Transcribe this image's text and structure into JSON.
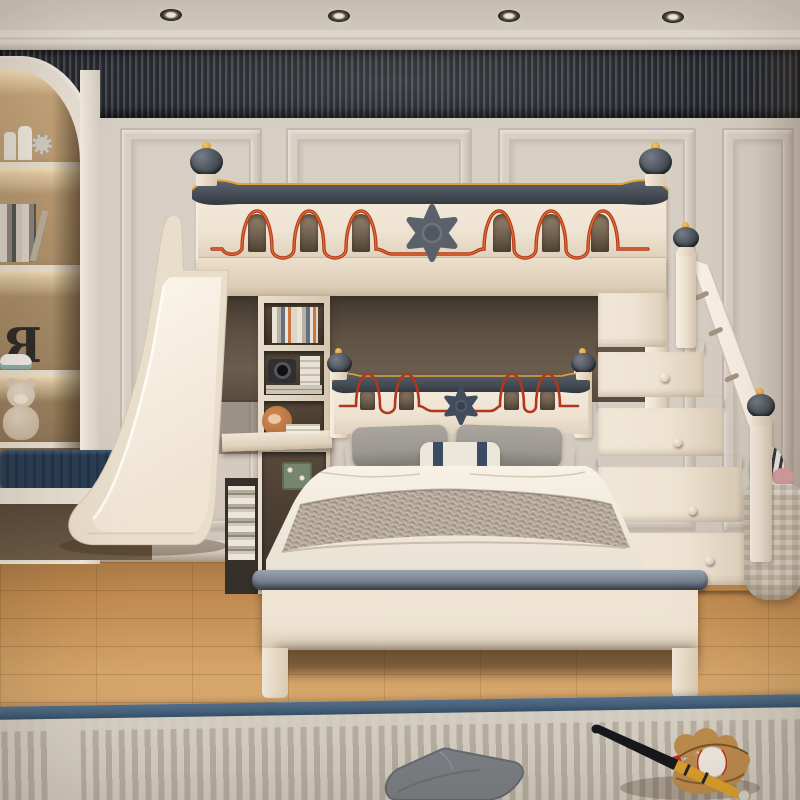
{
  "meta": {
    "type": "product-photo",
    "subject": "Children's castle-themed loft bunk bed with play slide, storage staircase and lower double bed in a panelled bedroom",
    "canvas": {
      "width": 800,
      "height": 800
    }
  },
  "scene": {
    "letter_decor": "R",
    "objects": [
      {
        "name": "ceiling-spotlights",
        "label": "Four recessed ceiling spotlights"
      },
      {
        "name": "slat-feature-wall",
        "label": "Dark fluted wood-slat feature wall above cream wainscot panels"
      },
      {
        "name": "built-in-bookcase",
        "label": "Arched built-in bookcase with warm shelf lighting, castle figurine, books, letter R, sneaker and teddy bear"
      },
      {
        "name": "window-bench",
        "label": "Navy ribbed window bench cushion"
      },
      {
        "name": "loft-bed",
        "label": "Cream loft bed with grey castellated rail, orange-red wave motif, arched slots and grey sheriff-star medallion"
      },
      {
        "name": "play-slide",
        "label": "Cream play slide descending from the loft"
      },
      {
        "name": "storage-staircase",
        "label": "Storage staircase with grey treads, drawer knobs, handrail and ball finials"
      },
      {
        "name": "lower-bed",
        "label": "Lower double bed with castle headboard, navy star, white bedding and knit throw"
      },
      {
        "name": "pillows",
        "label": "Grey, terracotta and navy-striped pillows"
      },
      {
        "name": "bookshelf-desk",
        "label": "Corner bookshelf-desk with books, camera, plush toy and floral tin"
      },
      {
        "name": "laundry-basket",
        "label": "Woven laundry basket with zebra plush"
      },
      {
        "name": "striped-rug",
        "label": "Beige striped rug with navy border"
      },
      {
        "name": "floor-cushion",
        "label": "Grey floor cushion on the rug"
      },
      {
        "name": "baseball-set",
        "label": "Baseball bat, leather glove and baseball"
      }
    ]
  },
  "colors": {
    "ceiling": "#ded6cb",
    "crown": "#eae3d8",
    "slat_dark": "#24262b",
    "slat_light": "#474b53",
    "wall": "#d8cfc4",
    "wall_line": "#c3b8ac",
    "baseboard": "#cec3b6",
    "niche_frame": "#e9e1d5",
    "niche_glow": "#f5e4c2",
    "cream": "#eee3d2",
    "cream_hi": "#f8f1e5",
    "cream_lo": "#d9cbb7",
    "rail_gray": "#4f555e",
    "gold": "#dfa13c",
    "wave_red": "#b0371c",
    "wave_orange": "#e2722e",
    "star_gray": "#5a616b",
    "star_navy": "#414d5d",
    "slot_dark": "#6e5f4e",
    "pillow_gray": "#9c9892",
    "salmon": "#d2906f",
    "stripe_navy": "#3c4d63",
    "blanket": "#b2a595",
    "sheet": "#f4eee1",
    "foot_rail": "#76818f",
    "tread": "#78828f",
    "floor_hi": "#d6a56a",
    "floor_lo": "#a97a45",
    "rug_field": "#d8d1c5",
    "rug_stripe": "#b9b1a4",
    "rug_navy": "#47627c",
    "bench": "#2c3e54",
    "basket": "#dcd2c2",
    "bat_dark": "#17181c",
    "bat_yellow": "#e2a42f",
    "glove": "#c08e4f",
    "ball": "#f3efe7",
    "stitch": "#c23327",
    "bear": "#d8c7b2"
  }
}
